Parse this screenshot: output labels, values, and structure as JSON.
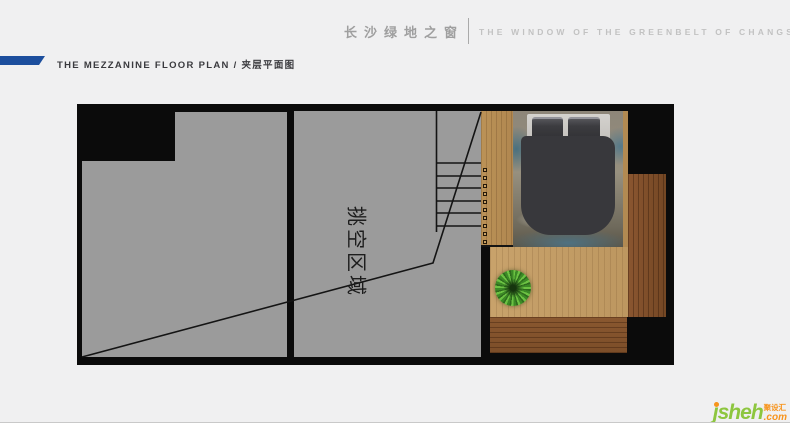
{
  "header": {
    "brand_cn": "长沙绿地之窗",
    "brand_en": "THE WINDOW OF THE GREENBELT OF CHANGSHA"
  },
  "title": {
    "text": "THE MEZZANINE FLOOR PLAN / 夹层平面图"
  },
  "plan": {
    "void_label": "挑空区域",
    "regions": {
      "left_room": "empty gray room",
      "void_room": "double-height void area",
      "stairs": "staircase with 6 treads",
      "walkway": "mezzanine wood walkway with railing balusters",
      "bedroom": "bed on rug over wood floor with plant"
    }
  },
  "logo": {
    "name": "jsheh",
    "suffix_cn": "聚设汇",
    "tld": ".com"
  },
  "colors": {
    "background": "#f0f0f1",
    "accent_blue": "#1c4e9d",
    "wall_black": "#0b0b0b",
    "room_gray": "#9b9b9b",
    "wood_light": "#c29c66",
    "wood_dark": "#7c4e29",
    "logo_green": "#8dc63f",
    "logo_orange": "#f7941d"
  }
}
